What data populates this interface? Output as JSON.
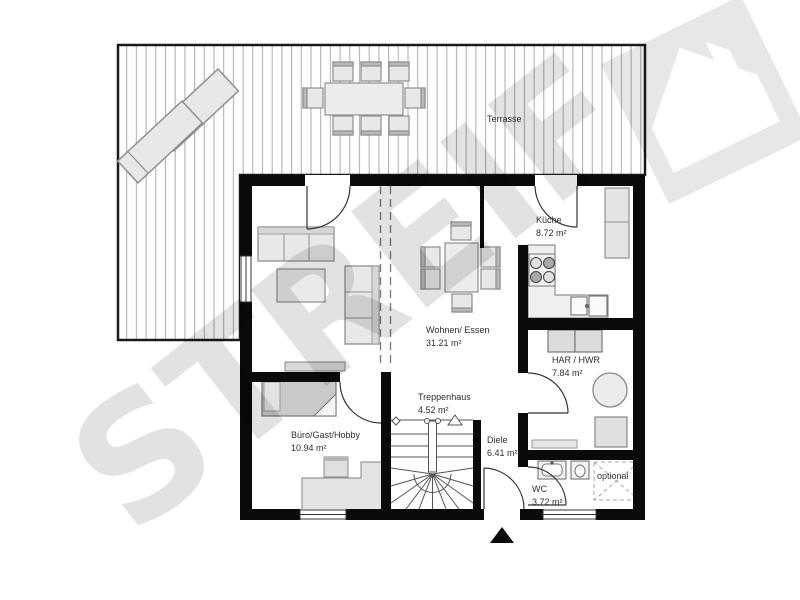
{
  "watermark": "STREIF",
  "logo": {
    "name": "streif-house-logo"
  },
  "rooms": {
    "terrasse": {
      "name": "Terrasse",
      "area": ""
    },
    "kueche": {
      "name": "Küche",
      "area": "8.72 m²"
    },
    "wohnen": {
      "name": "Wohnen/ Essen",
      "area": "31.21 m²"
    },
    "har": {
      "name": "HAR / HWR",
      "area": "7.84 m²"
    },
    "treppenhaus": {
      "name": "Treppenhaus",
      "area": "4.52 m²"
    },
    "buero": {
      "name": "Büro/Gast/Hobby",
      "area": "10.94 m²"
    },
    "diele": {
      "name": "Diele",
      "area": "6.41 m²"
    },
    "wc": {
      "name": "WC",
      "area": "3.72 m²"
    },
    "optional": {
      "name": "optional",
      "area": ""
    }
  },
  "colors": {
    "wall": "#0a0a0a",
    "furniture_fill": "#e8e8e8",
    "furniture_stroke": "#8f8f8f",
    "deck_line": "#ababab",
    "watermark_gray": "#e2e2e2"
  }
}
